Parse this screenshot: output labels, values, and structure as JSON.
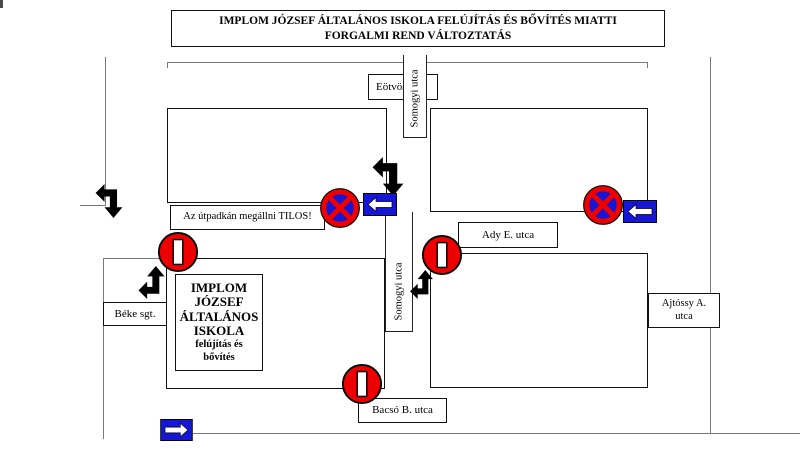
{
  "title": "IMPLOM JÓZSEF ÁLTALÁNOS ISKOLA FELÚJÍTÁS ÉS BŐVÍTÉS MIATTI FORGALMI REND VÁLTOZTATÁS",
  "notice": "Az útpadkán megállni TILOS!",
  "streets": {
    "eotvos": "Eötvös u.",
    "somogyi_upper": "Somogyi utca",
    "somogyi_lower": "Somogyi utca",
    "ady": "Ady E. utca",
    "ajtossy_line1": "Ajtóssy A.",
    "ajtossy_line2": "utca",
    "beke": "Béke sgt.",
    "bacso": "Bacsó B. utca"
  },
  "school": {
    "line1": "IMPLOM",
    "line2": "JÓZSEF",
    "line3": "ÁLTALÁNOS",
    "line4": "ISKOLA",
    "sub1": "felújítás és",
    "sub2": "bővítés"
  },
  "signs": {
    "no_entry": "no entry (tilted bar) sign",
    "no_stopping": "no stopping sign",
    "mandatory_left": "mandatory direction left sign",
    "mandatory_right": "mandatory direction right sign",
    "turn_arrow": "black detour turn arrow"
  },
  "colors": {
    "sign_red": "#ee0000",
    "sign_blue": "#1616d6"
  }
}
